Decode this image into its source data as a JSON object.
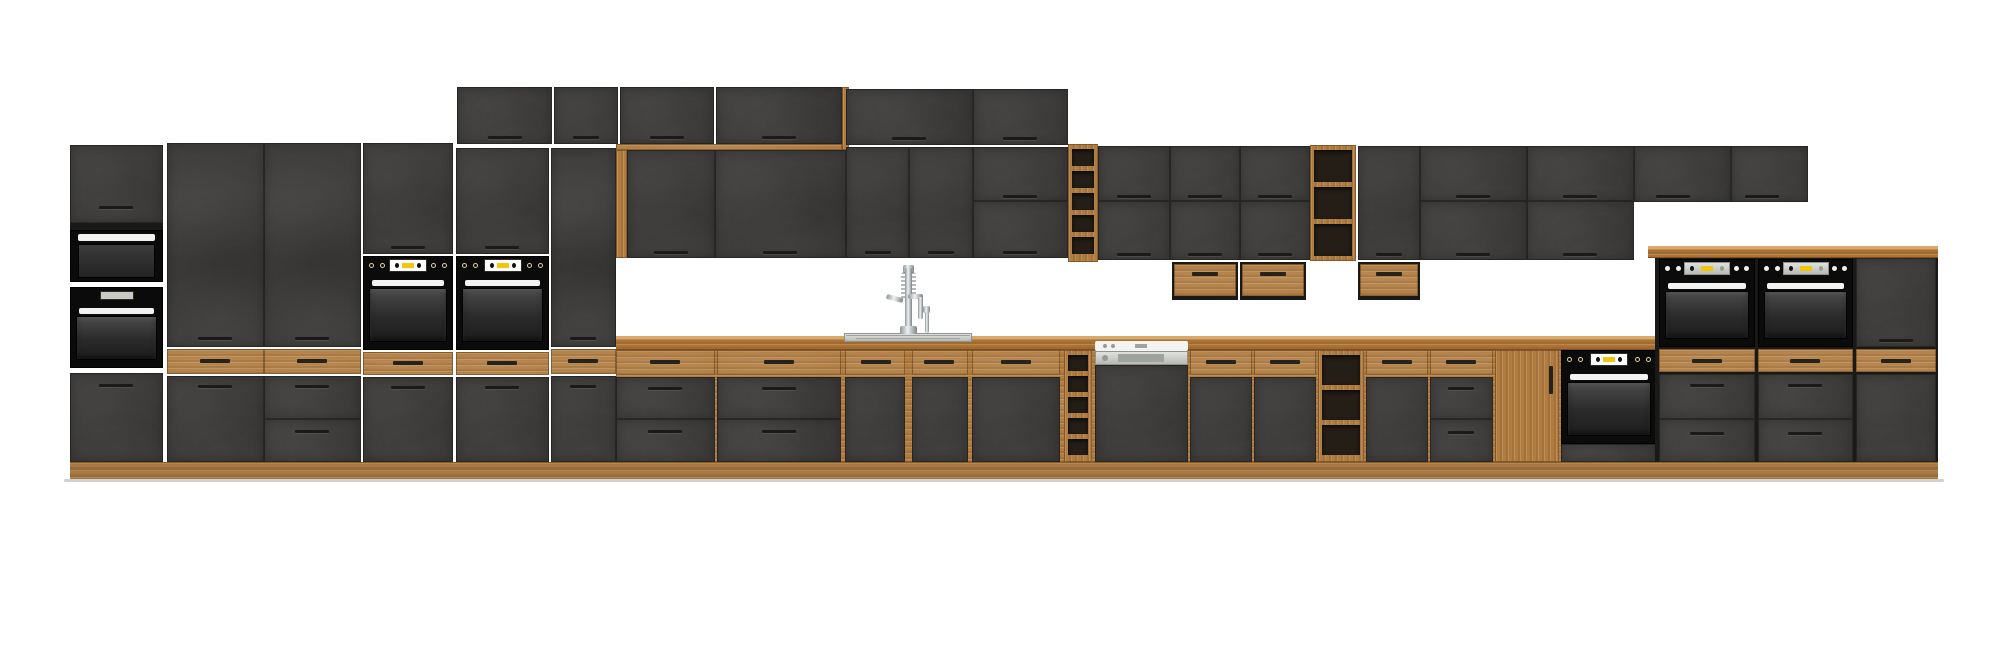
{
  "meta": {
    "label": "Kitchen cabinet set render - graphite fronts with oak accents",
    "width": 2000,
    "height": 662
  },
  "palette": {
    "front_dark": "#3f3e3c",
    "carcass": "#191918",
    "oak": "#b17c40",
    "oak_light": "#d9a96a",
    "oak_dark": "#8a5c28",
    "plinth": "#a87a42",
    "appliance_black": "#0b0b0b",
    "appliance_white": "#f3f3f1",
    "display_yellow": "#f2c50f",
    "steel": "#c9ccc6",
    "handle": "#1b1a19"
  },
  "modules": [
    {
      "t": "door",
      "n": "tall1-top-door",
      "x": 70,
      "y": 145,
      "w": 93,
      "h": 78,
      "hx": 116,
      "hy": 206
    },
    {
      "t": "rect",
      "n": "tall1-frame-strip",
      "x": 70,
      "y": 223,
      "w": 93,
      "h": 7,
      "cls": "f-carcass"
    },
    {
      "t": "mw",
      "n": "tall1-microwave",
      "x": 70,
      "y": 230,
      "w": 93,
      "h": 52
    },
    {
      "t": "oven",
      "n": "tall1-oven",
      "v": "plain",
      "x": 70,
      "y": 287,
      "w": 93,
      "h": 81
    },
    {
      "t": "door",
      "n": "tall1-bottom-door",
      "x": 70,
      "y": 373,
      "w": 93,
      "h": 89,
      "hx": 116,
      "hy": 384
    },
    {
      "t": "door",
      "n": "tall2-door",
      "x": 167,
      "y": 143,
      "w": 97,
      "h": 204,
      "hx": 215,
      "hy": 337
    },
    {
      "t": "oakdrawer",
      "n": "tall2-oak-drawer",
      "x": 167,
      "y": 349,
      "w": 97,
      "h": 25,
      "hx": 215,
      "hy": 359
    },
    {
      "t": "door",
      "n": "tall2-base-door",
      "x": 167,
      "y": 376,
      "w": 97,
      "h": 86,
      "hx": 215,
      "hy": 385
    },
    {
      "t": "door",
      "n": "tall3-door",
      "x": 264,
      "y": 143,
      "w": 97,
      "h": 204,
      "hx": 312,
      "hy": 337
    },
    {
      "t": "oakdrawer",
      "n": "tall3-oak-drawer",
      "x": 264,
      "y": 349,
      "w": 97,
      "h": 25,
      "hx": 312,
      "hy": 359
    },
    {
      "t": "drawer",
      "n": "tall3-drawer-1",
      "x": 264,
      "y": 376,
      "w": 97,
      "h": 43,
      "hx": 312,
      "hy": 385
    },
    {
      "t": "drawer",
      "n": "tall3-drawer-2",
      "x": 264,
      "y": 419,
      "w": 97,
      "h": 43,
      "hx": 312,
      "hy": 430
    },
    {
      "t": "door",
      "n": "tall4-top-door",
      "x": 363,
      "y": 143,
      "w": 90,
      "h": 111,
      "hx": 408,
      "hy": 246
    },
    {
      "t": "oven",
      "n": "tall4-oven",
      "v": "std",
      "x": 363,
      "y": 256,
      "w": 90,
      "h": 94
    },
    {
      "t": "oakdrawer",
      "n": "tall4-oak-drawer",
      "x": 363,
      "y": 352,
      "w": 90,
      "h": 23,
      "hx": 408,
      "hy": 361
    },
    {
      "t": "door",
      "n": "tall4-base-door",
      "x": 363,
      "y": 377,
      "w": 90,
      "h": 85,
      "hx": 408,
      "hy": 386
    },
    {
      "t": "door",
      "n": "tall5-top-door",
      "x": 456,
      "y": 148,
      "w": 93,
      "h": 106,
      "hx": 502,
      "hy": 246
    },
    {
      "t": "oven",
      "n": "tall5-oven",
      "v": "std",
      "x": 456,
      "y": 256,
      "w": 93,
      "h": 94
    },
    {
      "t": "oakdrawer",
      "n": "tall5-oak-drawer",
      "x": 456,
      "y": 352,
      "w": 93,
      "h": 23,
      "hx": 502,
      "hy": 361
    },
    {
      "t": "door",
      "n": "tall5-base-door",
      "x": 456,
      "y": 377,
      "w": 93,
      "h": 85,
      "hx": 502,
      "hy": 386
    },
    {
      "t": "door",
      "n": "tall6-door",
      "x": 551,
      "y": 148,
      "w": 65,
      "h": 199,
      "hx": 583,
      "hy": 337
    },
    {
      "t": "oakdrawer",
      "n": "tall6-oak-drawer",
      "x": 551,
      "y": 349,
      "w": 65,
      "h": 25,
      "hx": 583,
      "hy": 359
    },
    {
      "t": "door",
      "n": "tall6-base-door",
      "x": 551,
      "y": 376,
      "w": 65,
      "h": 86,
      "hx": 583,
      "hy": 385
    },
    {
      "t": "door",
      "n": "wall-high-door-1",
      "x": 457,
      "y": 87,
      "w": 95,
      "h": 57,
      "hx": 505,
      "hy": 136
    },
    {
      "t": "door",
      "n": "wall-high-door-2",
      "x": 554,
      "y": 87,
      "w": 64,
      "h": 57,
      "hx": 586,
      "hy": 136
    },
    {
      "t": "door",
      "n": "wall-high-door-3",
      "x": 620,
      "y": 87,
      "w": 94,
      "h": 57,
      "hx": 667,
      "hy": 136
    },
    {
      "t": "door",
      "n": "wall-high-door-4",
      "x": 716,
      "y": 87,
      "w": 126,
      "h": 57,
      "hx": 779,
      "hy": 136
    },
    {
      "t": "rect",
      "n": "wall-high-oak-side",
      "x": 842,
      "y": 87,
      "w": 7,
      "h": 63,
      "cls": "f-oakV"
    },
    {
      "t": "rect",
      "n": "niche-oak-trim-top",
      "x": 616,
      "y": 144,
      "w": 226,
      "h": 6,
      "cls": "f-oakH"
    },
    {
      "t": "rect",
      "n": "niche-oak-trim-side",
      "x": 616,
      "y": 150,
      "w": 11,
      "h": 108,
      "cls": "f-oakV"
    },
    {
      "t": "door",
      "n": "wall-sink-door-1",
      "x": 627,
      "y": 150,
      "w": 88,
      "h": 108,
      "hx": 671,
      "hy": 251
    },
    {
      "t": "door",
      "n": "wall-sink-door-2",
      "x": 715,
      "y": 150,
      "w": 131,
      "h": 108,
      "hx": 780,
      "hy": 251
    },
    {
      "t": "door",
      "n": "wall-a-top-door-1",
      "x": 846,
      "y": 89,
      "w": 127,
      "h": 56,
      "hx": 909,
      "hy": 137
    },
    {
      "t": "door",
      "n": "wall-a-top-door-2",
      "x": 973,
      "y": 89,
      "w": 95,
      "h": 56,
      "hx": 1020,
      "hy": 137
    },
    {
      "t": "door",
      "n": "wall-a-door-1",
      "x": 846,
      "y": 147,
      "w": 63,
      "h": 111,
      "hx": 878,
      "hy": 251
    },
    {
      "t": "door",
      "n": "wall-a-door-2",
      "x": 909,
      "y": 147,
      "w": 64,
      "h": 111,
      "hx": 941,
      "hy": 251
    },
    {
      "t": "door",
      "n": "wall-a-door-3",
      "x": 973,
      "y": 147,
      "w": 95,
      "h": 54,
      "hx": 1020,
      "hy": 195
    },
    {
      "t": "door",
      "n": "wall-a-door-4",
      "x": 973,
      "y": 201,
      "w": 95,
      "h": 57,
      "hx": 1020,
      "hy": 251
    },
    {
      "t": "shelf",
      "n": "wall-open-shelf-1",
      "x": 1068,
      "y": 144,
      "w": 30,
      "h": 118,
      "slots": 5
    },
    {
      "t": "door",
      "n": "wall-b-top-door-1",
      "x": 1098,
      "y": 146,
      "w": 72,
      "h": 55,
      "hx": 1134,
      "hy": 195
    },
    {
      "t": "door",
      "n": "wall-b-top-door-2",
      "x": 1170,
      "y": 146,
      "w": 70,
      "h": 55,
      "hx": 1205,
      "hy": 195
    },
    {
      "t": "door",
      "n": "wall-b-top-door-3",
      "x": 1240,
      "y": 146,
      "w": 70,
      "h": 55,
      "hx": 1275,
      "hy": 195
    },
    {
      "t": "door",
      "n": "wall-b-bottom-door-1",
      "x": 1098,
      "y": 201,
      "w": 72,
      "h": 59,
      "hx": 1134,
      "hy": 253
    },
    {
      "t": "door",
      "n": "wall-b-bottom-door-2",
      "x": 1170,
      "y": 201,
      "w": 70,
      "h": 59,
      "hx": 1205,
      "hy": 253
    },
    {
      "t": "door",
      "n": "wall-b-bottom-door-3",
      "x": 1240,
      "y": 201,
      "w": 70,
      "h": 59,
      "hx": 1275,
      "hy": 253
    },
    {
      "t": "box",
      "n": "hanging-drawer-box-1",
      "x": 1172,
      "y": 262,
      "w": 66,
      "h": 38,
      "hx": 1205,
      "hy": 272
    },
    {
      "t": "box",
      "n": "hanging-drawer-box-2",
      "x": 1240,
      "y": 262,
      "w": 66,
      "h": 38,
      "hx": 1273,
      "hy": 272
    },
    {
      "t": "shelf",
      "n": "wall-open-shelf-2",
      "x": 1310,
      "y": 145,
      "w": 46,
      "h": 116,
      "slots": 3
    },
    {
      "t": "door",
      "n": "wall-c-door",
      "x": 1358,
      "y": 146,
      "w": 62,
      "h": 114,
      "hx": 1389,
      "hy": 253
    },
    {
      "t": "box",
      "n": "hanging-drawer-box-3",
      "x": 1358,
      "y": 262,
      "w": 62,
      "h": 38,
      "hx": 1389,
      "hy": 272
    },
    {
      "t": "door",
      "n": "wall-c-top-door-1",
      "x": 1420,
      "y": 146,
      "w": 107,
      "h": 55,
      "hx": 1473,
      "hy": 195
    },
    {
      "t": "door",
      "n": "wall-c-bottom-door-1",
      "x": 1420,
      "y": 201,
      "w": 107,
      "h": 59,
      "hx": 1473,
      "hy": 253
    },
    {
      "t": "door",
      "n": "wall-c-top-door-2",
      "x": 1527,
      "y": 146,
      "w": 107,
      "h": 55,
      "hx": 1580,
      "hy": 195
    },
    {
      "t": "door",
      "n": "wall-c-bottom-door-2",
      "x": 1527,
      "y": 201,
      "w": 107,
      "h": 59,
      "hx": 1580,
      "hy": 253
    },
    {
      "t": "door",
      "n": "wall-d-door-1",
      "x": 1634,
      "y": 146,
      "w": 97,
      "h": 56,
      "hx": 1673,
      "hy": 195
    },
    {
      "t": "door",
      "n": "wall-d-door-2",
      "x": 1731,
      "y": 146,
      "w": 77,
      "h": 56,
      "hx": 1762,
      "hy": 195
    },
    {
      "t": "rect",
      "n": "base-run-underlay",
      "x": 616,
      "y": 350,
      "w": 1042,
      "h": 112,
      "cls": "f-oakH"
    },
    {
      "t": "worktop",
      "n": "worktop",
      "x": 616,
      "y": 336,
      "w": 1042,
      "h": 14
    },
    {
      "t": "oakdrawer",
      "n": "base1-oak-drawer",
      "x": 616,
      "y": 350,
      "w": 99,
      "h": 25,
      "hx": 665,
      "hy": 360
    },
    {
      "t": "drawer",
      "n": "base1-drawer-1",
      "x": 616,
      "y": 377,
      "w": 99,
      "h": 42,
      "hx": 665,
      "hy": 387
    },
    {
      "t": "drawer",
      "n": "base1-drawer-2",
      "x": 616,
      "y": 419,
      "w": 99,
      "h": 43,
      "hx": 665,
      "hy": 430
    },
    {
      "t": "oakdrawer",
      "n": "base2-oak-drawer",
      "x": 717,
      "y": 350,
      "w": 124,
      "h": 25,
      "hx": 779,
      "hy": 360
    },
    {
      "t": "drawer",
      "n": "base2-drawer-1",
      "x": 717,
      "y": 377,
      "w": 124,
      "h": 42,
      "hx": 779,
      "hy": 387
    },
    {
      "t": "drawer",
      "n": "base2-drawer-2",
      "x": 717,
      "y": 419,
      "w": 124,
      "h": 43,
      "hx": 779,
      "hy": 430
    },
    {
      "t": "oakdrawer",
      "n": "sink-base-oak-drawer-1",
      "x": 845,
      "y": 350,
      "w": 60,
      "h": 25,
      "hx": 876,
      "hy": 360
    },
    {
      "t": "door",
      "n": "sink-base-door-1",
      "x": 845,
      "y": 377,
      "w": 60,
      "h": 85
    },
    {
      "t": "oakdrawer",
      "n": "sink-base-oak-drawer-2",
      "x": 912,
      "y": 350,
      "w": 56,
      "h": 25,
      "hx": 939,
      "hy": 360
    },
    {
      "t": "door",
      "n": "sink-base-door-2",
      "x": 912,
      "y": 377,
      "w": 56,
      "h": 85
    },
    {
      "t": "oakdrawer",
      "n": "sink-base-oak-drawer-3",
      "x": 972,
      "y": 350,
      "w": 88,
      "h": 25,
      "hx": 1016,
      "hy": 360
    },
    {
      "t": "door",
      "n": "sink-base-door-3",
      "x": 972,
      "y": 377,
      "w": 88,
      "h": 85
    },
    {
      "t": "shelf",
      "n": "base-wine-rack",
      "x": 1064,
      "y": 350,
      "w": 28,
      "h": 112,
      "slots": 5
    },
    {
      "t": "dw",
      "n": "dishwasher",
      "x": 1095,
      "y": 341,
      "w": 93,
      "h": 121
    },
    {
      "t": "oakdrawer",
      "n": "base7-oak-drawer",
      "x": 1190,
      "y": 350,
      "w": 62,
      "h": 25,
      "hx": 1221,
      "hy": 360
    },
    {
      "t": "door",
      "n": "base7-door",
      "x": 1190,
      "y": 377,
      "w": 62,
      "h": 85
    },
    {
      "t": "oakdrawer",
      "n": "base8-oak-drawer",
      "x": 1254,
      "y": 350,
      "w": 62,
      "h": 25,
      "hx": 1285,
      "hy": 360
    },
    {
      "t": "door",
      "n": "base8-door",
      "x": 1254,
      "y": 377,
      "w": 62,
      "h": 85
    },
    {
      "t": "shelf",
      "n": "base-open-shelf",
      "x": 1318,
      "y": 350,
      "w": 46,
      "h": 112,
      "slots": 3
    },
    {
      "t": "oakdrawer",
      "n": "base9-oak-drawer",
      "x": 1366,
      "y": 350,
      "w": 62,
      "h": 25,
      "hx": 1397,
      "hy": 360
    },
    {
      "t": "door",
      "n": "base9-door",
      "x": 1366,
      "y": 377,
      "w": 62,
      "h": 85
    },
    {
      "t": "oakdrawer",
      "n": "base10-oak-drawer",
      "x": 1430,
      "y": 350,
      "w": 63,
      "h": 25,
      "hx": 1461,
      "hy": 360
    },
    {
      "t": "drawer",
      "n": "base10-drawer-1",
      "x": 1430,
      "y": 377,
      "w": 63,
      "h": 42,
      "hx": 1461,
      "hy": 387
    },
    {
      "t": "drawer",
      "n": "base10-drawer-2",
      "x": 1430,
      "y": 419,
      "w": 63,
      "h": 43,
      "hx": 1461,
      "hy": 431
    },
    {
      "t": "oakdoor",
      "n": "oak-pantry-door",
      "x": 1495,
      "y": 350,
      "w": 64,
      "h": 112,
      "vh": [
        54,
        16,
        4,
        28
      ]
    },
    {
      "t": "oven",
      "n": "base-built-under-oven",
      "v": "std",
      "x": 1561,
      "y": 350,
      "w": 96,
      "h": 94
    },
    {
      "t": "rect",
      "n": "base-oven-lower-panel",
      "x": 1561,
      "y": 444,
      "w": 96,
      "h": 18,
      "cls": "f-dark"
    },
    {
      "t": "sink",
      "n": "sink",
      "x": 844,
      "y": 333,
      "w": 128,
      "h": 9
    },
    {
      "t": "faucet",
      "n": "faucet",
      "x": 886,
      "y": 265,
      "w": 46,
      "h": 70
    },
    {
      "t": "cap",
      "n": "tower-worktop-cap",
      "x": 1648,
      "y": 246,
      "w": 290,
      "h": 12
    },
    {
      "t": "rect",
      "n": "tower-underlay",
      "x": 1655,
      "y": 258,
      "w": 283,
      "h": 204,
      "cls": "f-carcass"
    },
    {
      "t": "oven",
      "n": "tower-oven-1",
      "v": "steel",
      "x": 1659,
      "y": 259,
      "w": 96,
      "h": 88
    },
    {
      "t": "oakdrawer",
      "n": "tower1-oak-drawer",
      "x": 1659,
      "y": 349,
      "w": 96,
      "h": 23,
      "hx": 1707,
      "hy": 359
    },
    {
      "t": "drawer",
      "n": "tower1-drawer-1",
      "x": 1659,
      "y": 374,
      "w": 96,
      "h": 45,
      "hx": 1707,
      "hy": 384
    },
    {
      "t": "drawer",
      "n": "tower1-drawer-2",
      "x": 1659,
      "y": 419,
      "w": 96,
      "h": 43,
      "hx": 1707,
      "hy": 432
    },
    {
      "t": "oven",
      "n": "tower-oven-2",
      "v": "steel",
      "x": 1758,
      "y": 259,
      "w": 95,
      "h": 88
    },
    {
      "t": "oakdrawer",
      "n": "tower2-oak-drawer",
      "x": 1758,
      "y": 349,
      "w": 95,
      "h": 23,
      "hx": 1805,
      "hy": 359
    },
    {
      "t": "drawer",
      "n": "tower2-drawer-1",
      "x": 1758,
      "y": 374,
      "w": 95,
      "h": 45,
      "hx": 1805,
      "hy": 384
    },
    {
      "t": "drawer",
      "n": "tower2-drawer-2",
      "x": 1758,
      "y": 419,
      "w": 95,
      "h": 43,
      "hx": 1805,
      "hy": 432
    },
    {
      "t": "door",
      "n": "tower-end-top-door",
      "x": 1856,
      "y": 258,
      "w": 80,
      "h": 89,
      "hx": 1896,
      "hy": 339
    },
    {
      "t": "oakdrawer",
      "n": "tower-end-oak-drawer",
      "x": 1856,
      "y": 349,
      "w": 80,
      "h": 23,
      "hx": 1896,
      "hy": 359
    },
    {
      "t": "door",
      "n": "tower-end-base-door",
      "x": 1856,
      "y": 374,
      "w": 80,
      "h": 88
    },
    {
      "t": "plinth",
      "n": "plinth",
      "x": 70,
      "y": 462,
      "w": 1868,
      "h": 17
    },
    {
      "t": "rect",
      "n": "floor-shadow",
      "x": 64,
      "y": 479,
      "w": 1880,
      "h": 3,
      "cls": "f-shadow"
    }
  ]
}
